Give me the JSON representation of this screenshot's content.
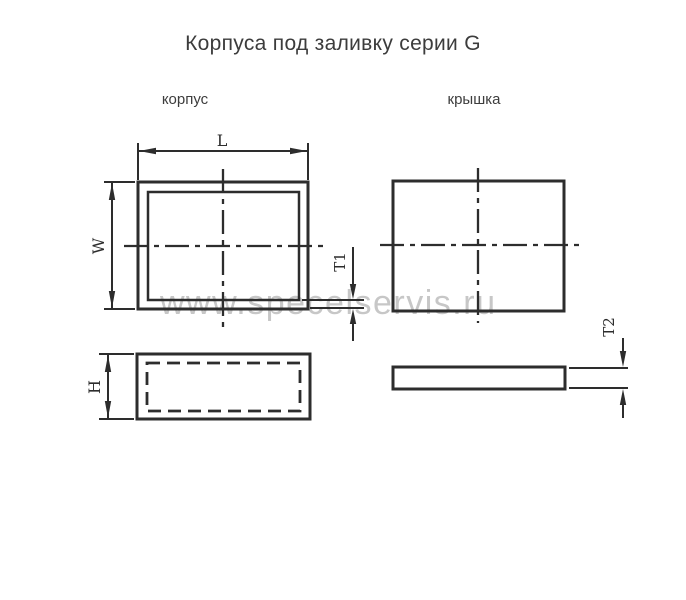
{
  "labels": {
    "title": "Корпуса под заливку серии  G",
    "body_view": "корпус",
    "lid_view": "крышка",
    "dim_L": "L",
    "dim_W": "W",
    "dim_H": "H",
    "dim_T1": "T1",
    "dim_T2": "T2"
  },
  "watermark": {
    "text": "www.specelservis.ru"
  },
  "colors": {
    "line": "#2d2d2d",
    "text": "#3c3c3c",
    "watermark": "#c1c1c1",
    "background": "#ffffff"
  }
}
